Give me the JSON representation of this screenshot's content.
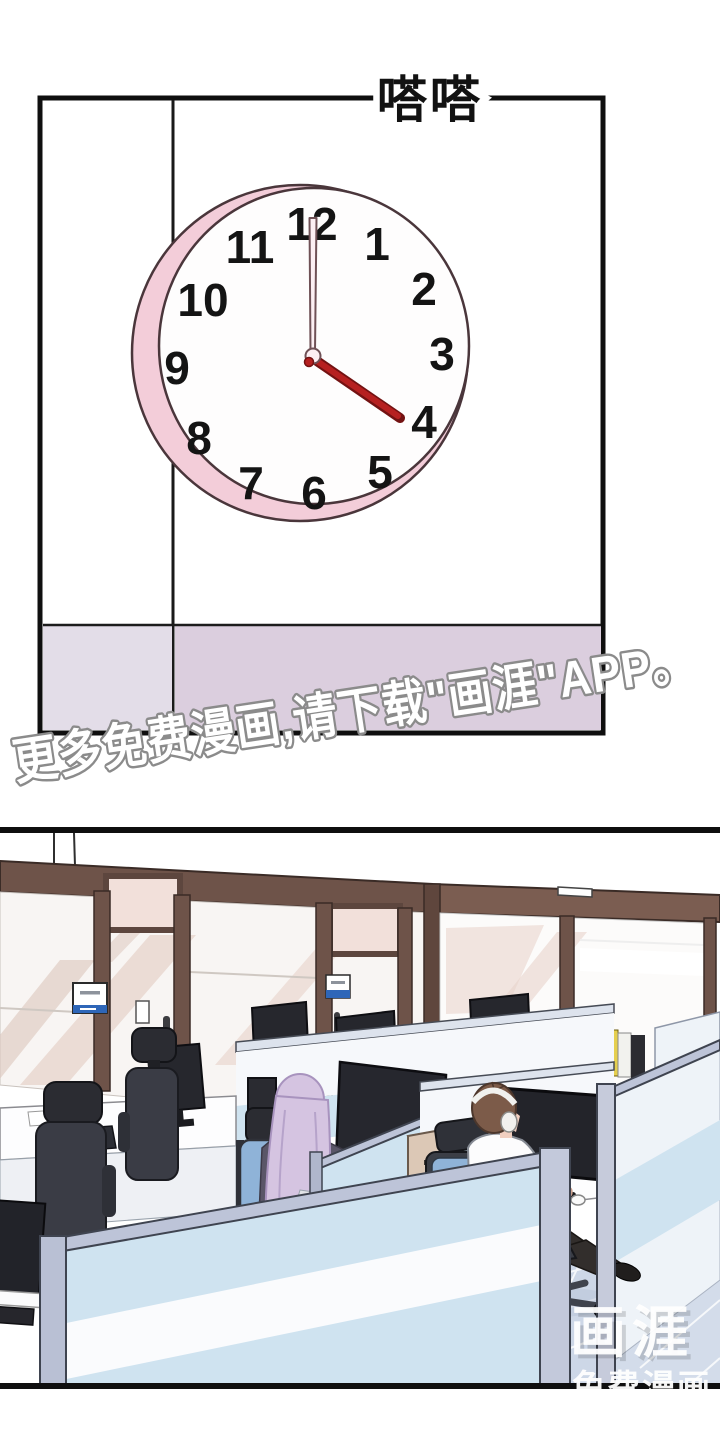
{
  "panel1": {
    "sfx": "嗒嗒",
    "clock": {
      "time_shown": "4:00",
      "numbers": [
        "12",
        "1",
        "2",
        "3",
        "4",
        "5",
        "6",
        "7",
        "8",
        "9",
        "10",
        "11"
      ],
      "colors": {
        "rim": "#f3cdd9",
        "face": "#fefdfd",
        "outline": "#4a363b",
        "hour_hand": "#b62020",
        "hour_hand_edge": "#731212",
        "minute_hand": "#fceff3",
        "numbers": "#141414"
      }
    },
    "wall": {
      "band_left_color": "#e3dde8",
      "band_right_color": "#dbcede",
      "line_color": "#1a1a1a"
    }
  },
  "watermark": {
    "text": "更多免费漫画,请下载\"画涯\"APP。",
    "fill": "#ffffff",
    "outline": "#8b8b8b"
  },
  "panel2": {
    "scene": "office-cubicles",
    "colors": {
      "door_frame": "#6e5349",
      "glass_streak": "#e9d7cf",
      "partition_blue": "#cfe3f0",
      "partition_cap": "#bdc4d8",
      "chair_cushion": "#8fb3d8",
      "floor": "#cdd7e7",
      "sign_blue": "#2e66b8",
      "woman_hair": "#d5c4e1",
      "man_hair": "#7c5b49"
    },
    "logo": {
      "title": "画涯",
      "subtitle": "免费漫画"
    }
  }
}
